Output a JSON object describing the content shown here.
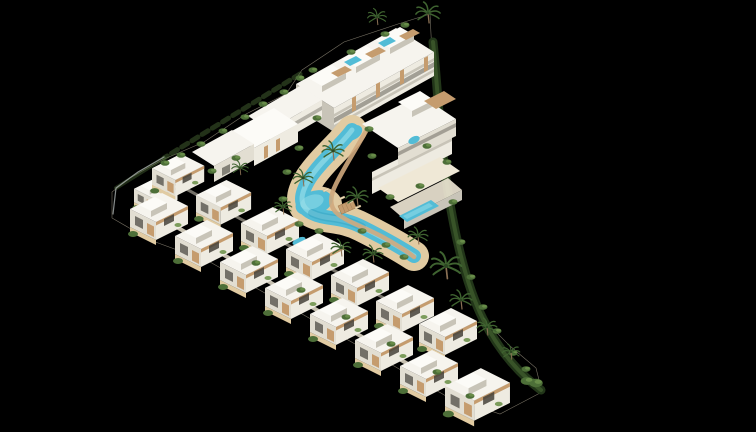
{
  "meta": {
    "description": "Aerial 3D architectural rendering of a white Mediterranean residential complex on a black background: a triangular plot with apartment blocks along the top and right, two stair-stepped rows of white villas along the bottom-left edge, a winding turquoise lagoon-style pool with sandy decks, a wooden bridge, sun loungers, palm trees and a curved green hedge along the right boundary."
  },
  "palette": {
    "background": "#000000",
    "site_base": "#ddd3bd",
    "roof_white": "#f6f4ee",
    "roof_bright": "#fcfbf7",
    "wall_light": "#eeebe1",
    "wall_mid": "#e2ded2",
    "wall_shadow": "#c8c4b8",
    "window_dark": "#45423a",
    "wood": "#c59c6e",
    "deck_sand": "#e1cba2",
    "path_sand": "#cfa87d",
    "terrace": "#efe8d6",
    "road": "#e9e2cf",
    "pool": "#52bcd6",
    "pool_light": "#9adfe9",
    "pool_deep": "#2e9cbc",
    "green": "#4d6f38",
    "green_bright": "#6f944e",
    "green_dark": "#2c4722",
    "hedge": "#223619",
    "fence": "#9fa4a3",
    "palm_green": "#3f6330",
    "trunk": "#8a7054",
    "lounger": "#ead9b6"
  },
  "scene": {
    "inner_villas": [
      {
        "x": 134,
        "y": 176,
        "s": 0.75
      },
      {
        "x": 152,
        "y": 153,
        "s": 0.9
      },
      {
        "x": 196,
        "y": 179,
        "s": 0.95
      },
      {
        "x": 241,
        "y": 206,
        "s": 1
      },
      {
        "x": 286,
        "y": 232,
        "s": 1
      },
      {
        "x": 331,
        "y": 258,
        "s": 1
      },
      {
        "x": 376,
        "y": 284,
        "s": 1
      },
      {
        "x": 419,
        "y": 307,
        "s": 1
      }
    ],
    "outer_villas": [
      {
        "x": 130,
        "y": 192,
        "s": 1
      },
      {
        "x": 175,
        "y": 219,
        "s": 1
      },
      {
        "x": 220,
        "y": 245,
        "s": 1
      },
      {
        "x": 265,
        "y": 271,
        "s": 1
      },
      {
        "x": 310,
        "y": 297,
        "s": 1
      },
      {
        "x": 355,
        "y": 323,
        "s": 1
      },
      {
        "x": 400,
        "y": 349,
        "s": 1
      },
      {
        "x": 445,
        "y": 367,
        "s": 1.12
      }
    ],
    "palms": [
      {
        "x": 428,
        "y": 13,
        "s": 1.1
      },
      {
        "x": 377,
        "y": 17,
        "s": 0.85
      },
      {
        "x": 333,
        "y": 151,
        "s": 1
      },
      {
        "x": 303,
        "y": 178,
        "s": 0.9
      },
      {
        "x": 357,
        "y": 197,
        "s": 1
      },
      {
        "x": 283,
        "y": 207,
        "s": 0.8
      },
      {
        "x": 341,
        "y": 248,
        "s": 0.9
      },
      {
        "x": 373,
        "y": 254,
        "s": 0.9
      },
      {
        "x": 418,
        "y": 236,
        "s": 0.9
      },
      {
        "x": 446,
        "y": 266,
        "s": 1.4
      },
      {
        "x": 461,
        "y": 300,
        "s": 1
      },
      {
        "x": 487,
        "y": 327,
        "s": 0.9
      },
      {
        "x": 240,
        "y": 168,
        "s": 0.75
      },
      {
        "x": 511,
        "y": 352,
        "s": 0.8
      }
    ],
    "shrubs": [
      {
        "x": 300,
        "y": 78
      },
      {
        "x": 284,
        "y": 92
      },
      {
        "x": 263,
        "y": 104
      },
      {
        "x": 245,
        "y": 117
      },
      {
        "x": 223,
        "y": 131
      },
      {
        "x": 201,
        "y": 144
      },
      {
        "x": 181,
        "y": 155
      },
      {
        "x": 165,
        "y": 163
      },
      {
        "x": 236,
        "y": 158
      },
      {
        "x": 212,
        "y": 171
      },
      {
        "x": 317,
        "y": 118
      },
      {
        "x": 299,
        "y": 148
      },
      {
        "x": 287,
        "y": 172
      },
      {
        "x": 283,
        "y": 199
      },
      {
        "x": 299,
        "y": 224
      },
      {
        "x": 319,
        "y": 231
      },
      {
        "x": 362,
        "y": 231
      },
      {
        "x": 386,
        "y": 245
      },
      {
        "x": 404,
        "y": 257
      },
      {
        "x": 372,
        "y": 156
      },
      {
        "x": 390,
        "y": 197
      },
      {
        "x": 369,
        "y": 129
      },
      {
        "x": 447,
        "y": 162
      },
      {
        "x": 453,
        "y": 202
      },
      {
        "x": 461,
        "y": 242
      },
      {
        "x": 471,
        "y": 277
      },
      {
        "x": 483,
        "y": 307
      },
      {
        "x": 497,
        "y": 331
      },
      {
        "x": 513,
        "y": 353
      },
      {
        "x": 526,
        "y": 369
      },
      {
        "x": 536,
        "y": 383,
        "s": 1.5
      },
      {
        "x": 527,
        "y": 381,
        "s": 1.4
      },
      {
        "x": 256,
        "y": 263
      },
      {
        "x": 301,
        "y": 290
      },
      {
        "x": 346,
        "y": 317
      },
      {
        "x": 391,
        "y": 344
      },
      {
        "x": 437,
        "y": 372
      },
      {
        "x": 470,
        "y": 396
      },
      {
        "x": 313,
        "y": 70
      },
      {
        "x": 351,
        "y": 52
      },
      {
        "x": 385,
        "y": 34
      },
      {
        "x": 405,
        "y": 25
      },
      {
        "x": 427,
        "y": 146
      },
      {
        "x": 420,
        "y": 186
      }
    ],
    "loungers": [
      {
        "x": 342,
        "y": 198,
        "r": -24
      },
      {
        "x": 350,
        "y": 202,
        "r": -24
      },
      {
        "x": 358,
        "y": 207,
        "r": -24
      },
      {
        "x": 326,
        "y": 190,
        "r": -24
      }
    ]
  }
}
